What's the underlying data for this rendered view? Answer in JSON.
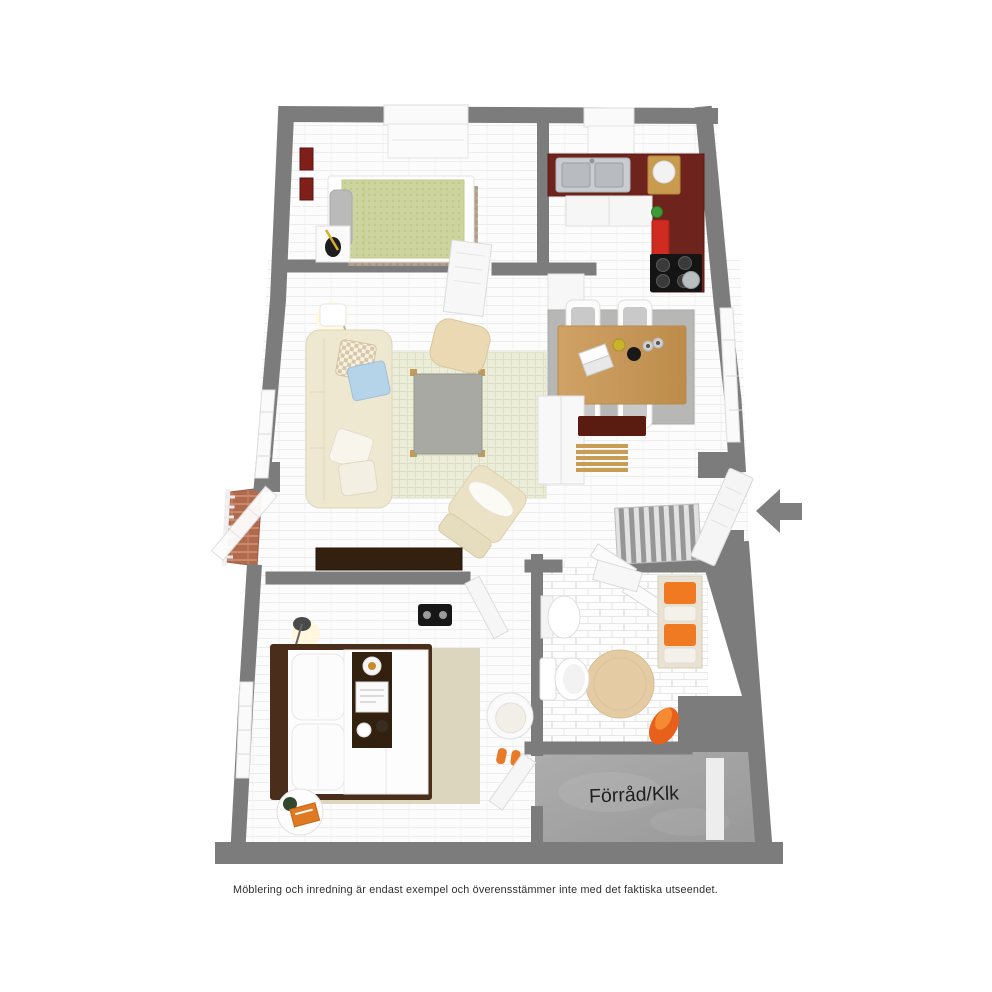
{
  "page": {
    "background_color": "#ffffff"
  },
  "floor_plan": {
    "storage_label": "Förråd/Klk",
    "entrance_arrow_icon": "arrow-left",
    "colors": {
      "wall": "#7c7c7c",
      "floor": "#fcfcfc",
      "counter_maroon": "#6e241c",
      "wood": "#c79a5a",
      "accent_orange": "#ee7a24",
      "rug_green": "#ecedd8",
      "duvet_green": "#cdd49f",
      "terracotta": "#b26a4f",
      "concrete": "#a3a3a3",
      "bed_frame_dark": "#4a2d1a"
    },
    "rooms": [
      {
        "name": "bedroom-small",
        "items": [
          "single-bed",
          "nightstand-with-guitar",
          "area-rug",
          "window-bench",
          "wall-art"
        ]
      },
      {
        "name": "kitchen",
        "items": [
          "double-sink",
          "l-shaped-counter",
          "cooktop",
          "cutting-board",
          "red-canister",
          "base-cabinets",
          "window-bench"
        ]
      },
      {
        "name": "living-room",
        "items": [
          "sofa",
          "throw-pillows",
          "checkered-rug",
          "concrete-coffee-table",
          "pouf",
          "lounge-chair",
          "floor-lamp",
          "media-sideboard"
        ]
      },
      {
        "name": "dining-area",
        "items": [
          "wooden-table",
          "four-chairs",
          "gray-rug",
          "laptop",
          "bowls"
        ]
      },
      {
        "name": "hallway-entry",
        "items": [
          "front-door",
          "striped-rug",
          "closet-doors",
          "wardrobe",
          "shoe-bench",
          "slatted-bench"
        ]
      },
      {
        "name": "balcony",
        "items": [
          "railing",
          "brick-floor",
          "glass-door"
        ]
      },
      {
        "name": "bathroom",
        "items": [
          "pedestal-sink",
          "toilet",
          "round-rug",
          "towel-shelf",
          "bathrobe"
        ]
      },
      {
        "name": "bedroom-master",
        "items": [
          "double-bed",
          "bed-tray",
          "pillows",
          "area-rug",
          "round-side-table",
          "armchair",
          "slippers",
          "floor-lamp",
          "boombox"
        ]
      },
      {
        "name": "storage",
        "items": [
          "concrete-floor"
        ]
      }
    ]
  },
  "caption": "Möblering och inredning är endast exempel och överensstämmer inte med det faktiska utseendet."
}
